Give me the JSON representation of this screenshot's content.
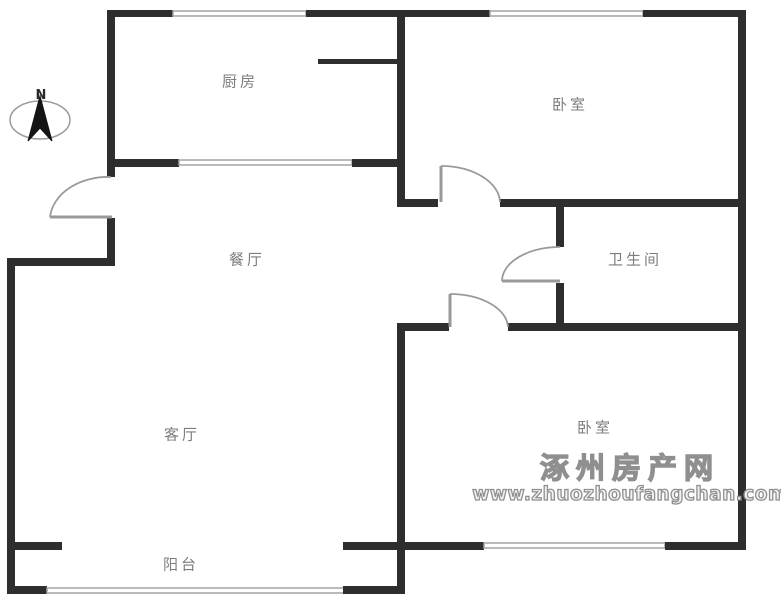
{
  "compass": {
    "label": "N"
  },
  "rooms": [
    {
      "id": "kitchen",
      "label": "厨房"
    },
    {
      "id": "bedroom-top",
      "label": "卧室"
    },
    {
      "id": "dining",
      "label": "餐厅"
    },
    {
      "id": "bathroom",
      "label": "卫生间"
    },
    {
      "id": "living",
      "label": "客厅"
    },
    {
      "id": "bedroom-bottom",
      "label": "卧室"
    },
    {
      "id": "balcony",
      "label": "阳台"
    }
  ],
  "watermark": {
    "site_name": "涿州房产网",
    "site_url": "www.zhuozhoufangchan.com"
  },
  "colors": {
    "wall": "#2e2e2e",
    "window": "#a3a3a3",
    "door": "#9a9a9a",
    "label": "#7d7d7d",
    "watermark": "#8f8f8f"
  }
}
